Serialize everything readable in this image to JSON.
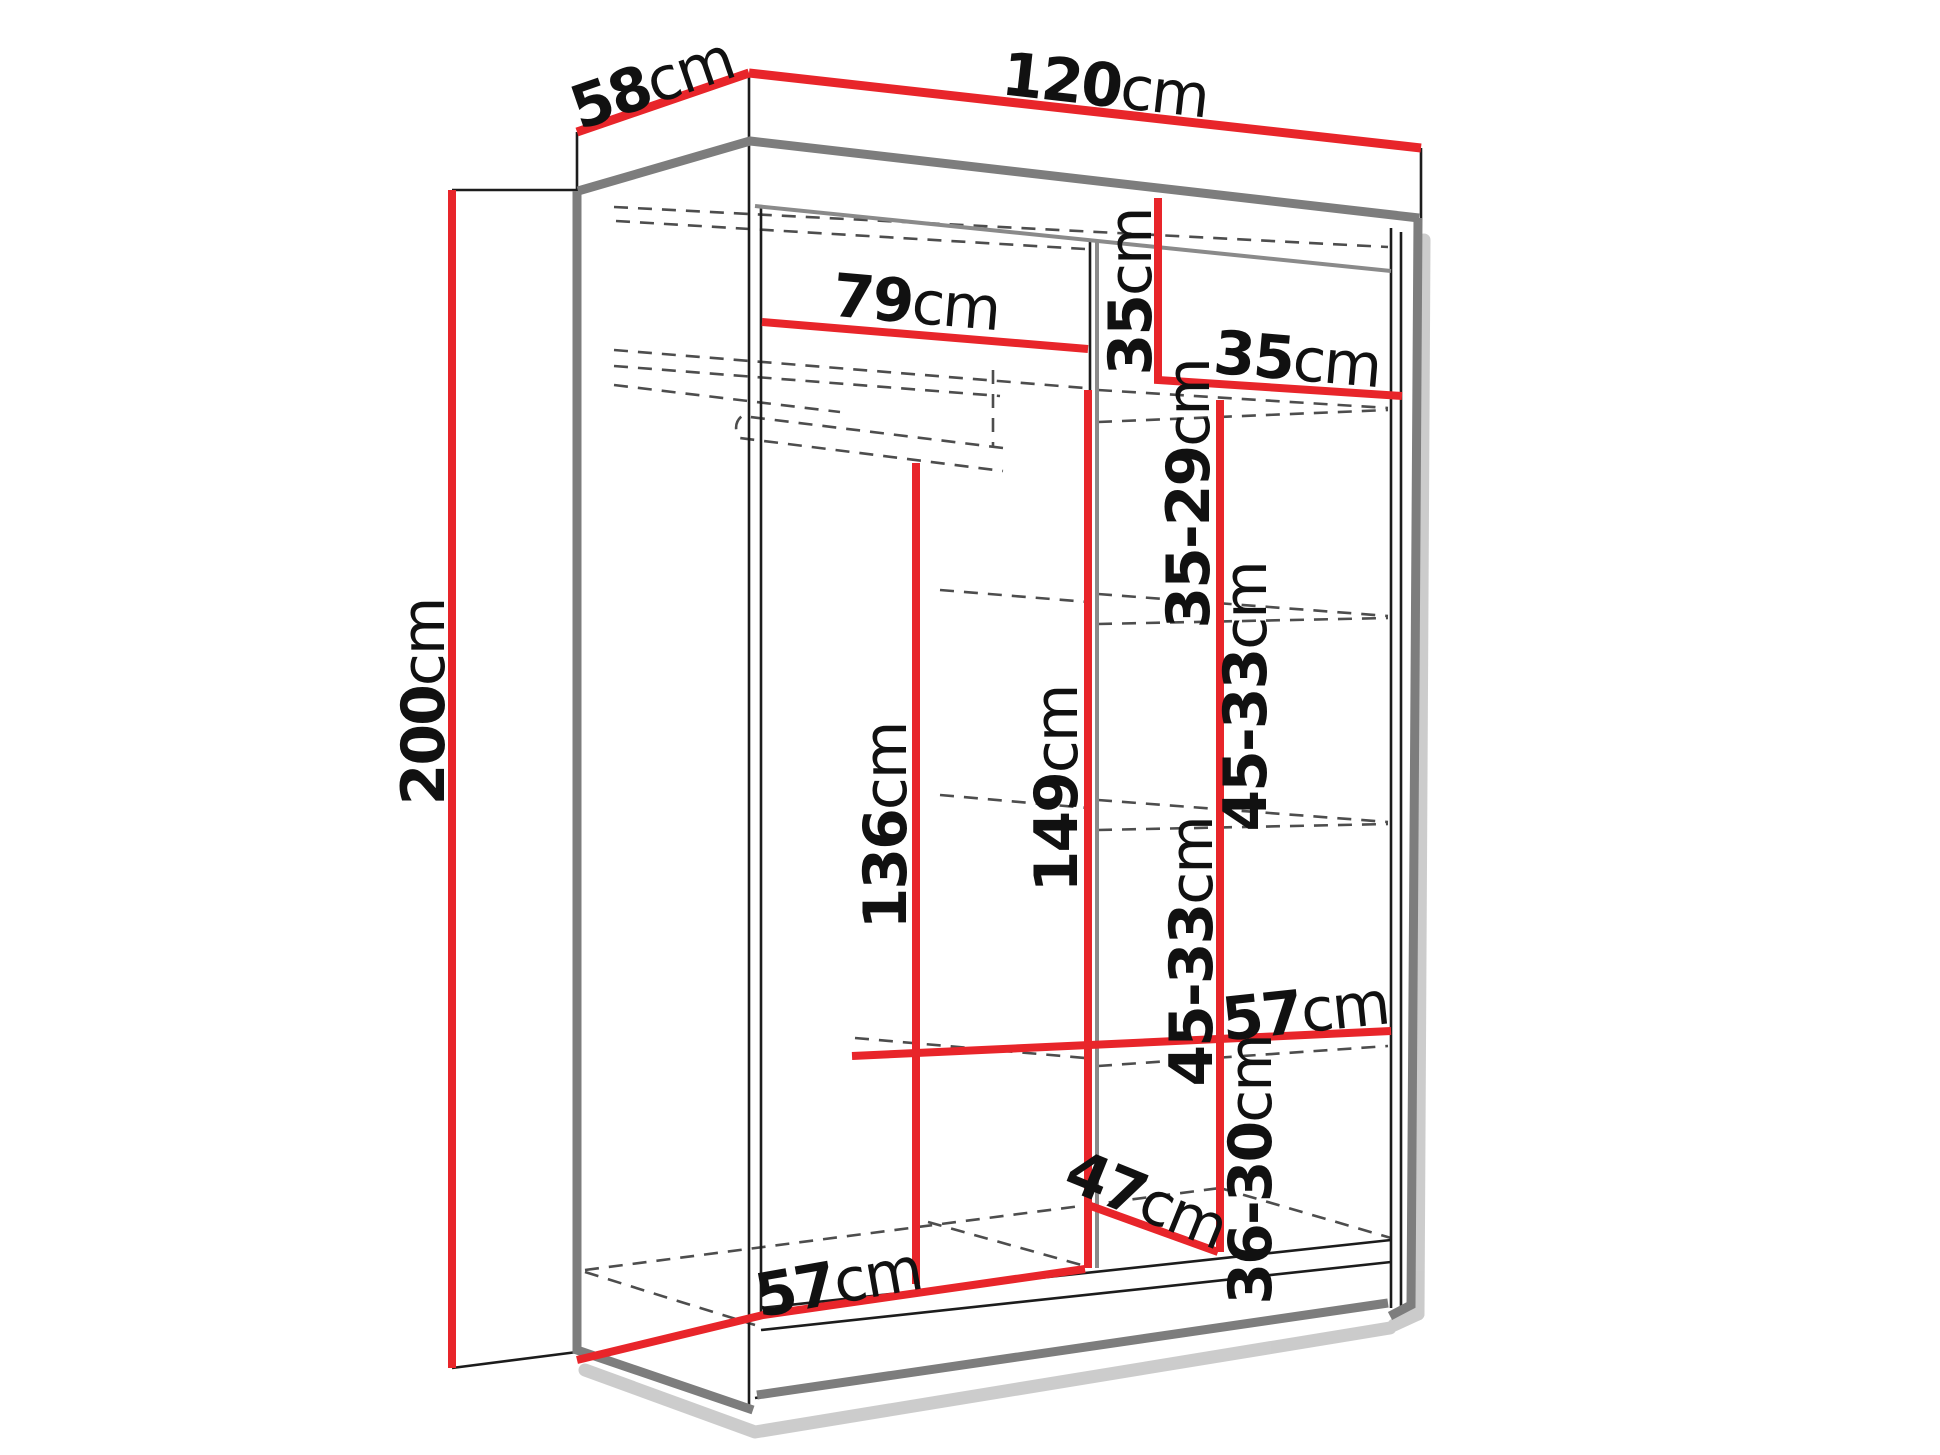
{
  "diagram": {
    "type": "furniture-dimension-drawing",
    "subject": "two-door sliding wardrobe, open-front 3D line drawing with red dimension lines",
    "unit": "cm"
  },
  "colors": {
    "dimension_line_red": "#e8252a",
    "outline_gray": "#7d7d7d",
    "edge_black": "#1c1c1c",
    "hidden_edge_dash": "#4d4d4d",
    "shadow": "#aaaaaa",
    "background": "#ffffff",
    "text": "#111111"
  },
  "labels": [
    {
      "id": "depth-top",
      "value": "58",
      "unit": "cm",
      "x": 652,
      "y": 84,
      "rot": -19
    },
    {
      "id": "width-top",
      "value": "120",
      "unit": "cm",
      "x": 1105,
      "y": 86,
      "rot": 6.5
    },
    {
      "id": "height-left",
      "value": "200",
      "unit": "cm",
      "x": 424,
      "y": 702,
      "rot": -90
    },
    {
      "id": "left-section-width",
      "value": "79",
      "unit": "cm",
      "x": 916,
      "y": 303,
      "rot": 5
    },
    {
      "id": "top-shelf-height",
      "value": "35",
      "unit": "cm",
      "x": 1131,
      "y": 292,
      "rot": -90
    },
    {
      "id": "right-section-width",
      "value": "35",
      "unit": "cm",
      "x": 1297,
      "y": 360,
      "rot": 5
    },
    {
      "id": "shelf-gap-1",
      "value": "35-29",
      "unit": "cm",
      "x": 1189,
      "y": 494,
      "rot": -90
    },
    {
      "id": "shelf-gap-2",
      "value": "45-33",
      "unit": "cm",
      "x": 1246,
      "y": 697,
      "rot": -90
    },
    {
      "id": "hanging-space-height",
      "value": "136",
      "unit": "cm",
      "x": 886,
      "y": 826,
      "rot": -90
    },
    {
      "id": "left-section-height",
      "value": "149",
      "unit": "cm",
      "x": 1057,
      "y": 789,
      "rot": -90
    },
    {
      "id": "shelf-gap-3",
      "value": "45-33",
      "unit": "cm",
      "x": 1192,
      "y": 952,
      "rot": -90
    },
    {
      "id": "shelf-depth-top",
      "value": "57",
      "unit": "cm",
      "x": 1305,
      "y": 1012,
      "rot": -6
    },
    {
      "id": "shelf-gap-4",
      "value": "36-30",
      "unit": "cm",
      "x": 1251,
      "y": 1170,
      "rot": -90
    },
    {
      "id": "bottom-diagonal",
      "value": "47",
      "unit": "cm",
      "x": 1146,
      "y": 1200,
      "rot": 22
    },
    {
      "id": "floor-depth",
      "value": "57",
      "unit": "cm",
      "x": 838,
      "y": 1283,
      "rot": -10
    }
  ]
}
